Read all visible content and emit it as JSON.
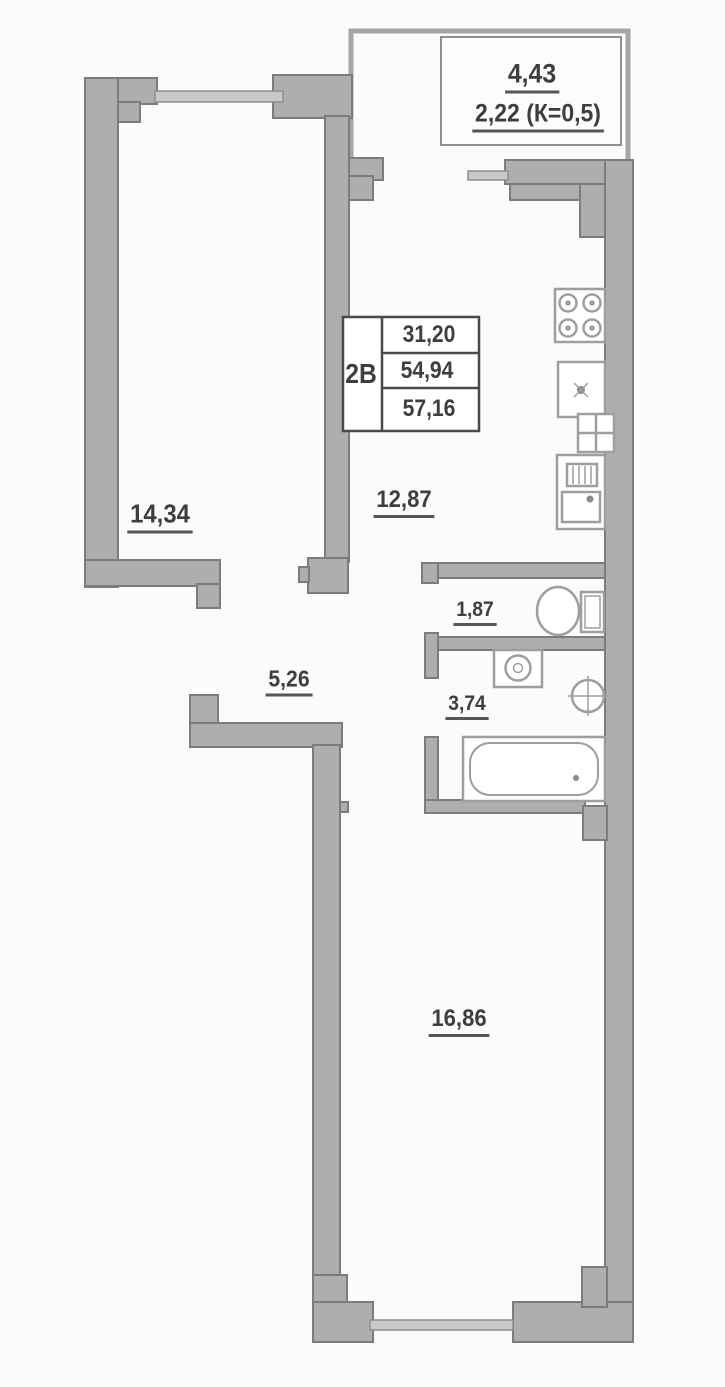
{
  "floor_plan": {
    "unit_type_label": "2В",
    "legend": {
      "living_area": "31,20",
      "apartment_area": "54,94",
      "total_area": "57,16"
    },
    "balcony": {
      "area": "4,43",
      "coefficient_area": "2,22 (К=0,5)"
    },
    "rooms": {
      "bedroom": "14,34",
      "kitchen_living": "12,87",
      "hallway": "5,26",
      "wc": "1,87",
      "bathroom": "3,74",
      "living_room": "16,86"
    }
  }
}
